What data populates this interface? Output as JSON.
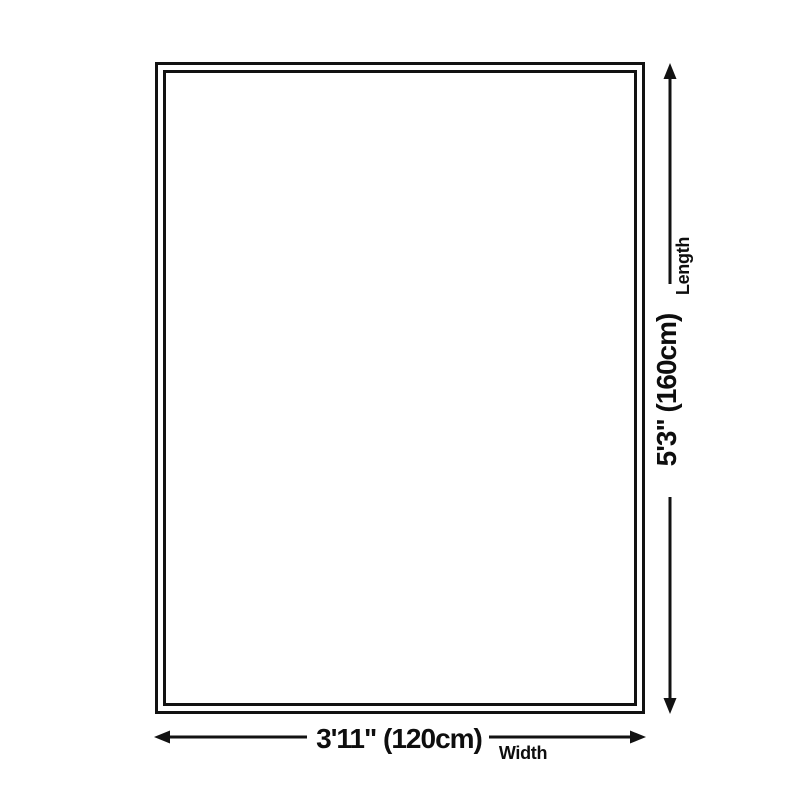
{
  "page": {
    "background_color": "#ffffff",
    "ink_color": "#121212"
  },
  "diagram": {
    "length": {
      "value": "5'3\" (160cm)",
      "label": "Length"
    },
    "width": {
      "value": "3'11\" (120cm)",
      "label": "Width"
    },
    "icons": {
      "length_arrow": "vertical-double-headed-arrow",
      "width_arrow": "horizontal-double-headed-arrow"
    }
  }
}
